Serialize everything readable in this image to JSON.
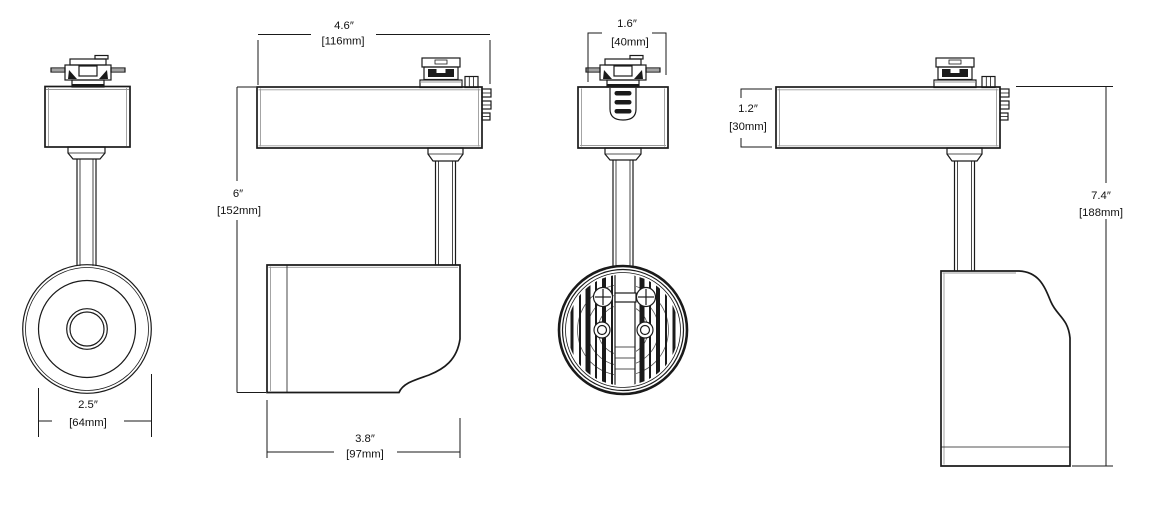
{
  "drawing": {
    "type": "dimension-drawing",
    "subject": "track-light-fixture",
    "line_color": "#1a1a1a",
    "background_color": "#ffffff"
  },
  "dimensions": {
    "lens_diameter": {
      "inches": "2.5″",
      "metric": "[64mm]"
    },
    "housing_length": {
      "inches": "4.6″",
      "metric": "[116mm]"
    },
    "fixture_height": {
      "inches": "6″",
      "metric": "[152mm]"
    },
    "head_length": {
      "inches": "3.8″",
      "metric": "[97mm]"
    },
    "adapter_width": {
      "inches": "1.6″",
      "metric": "[40mm]"
    },
    "housing_height": {
      "inches": "1.2″",
      "metric": "[30mm]"
    },
    "overall_height": {
      "inches": "7.4″",
      "metric": "[188mm]"
    }
  }
}
